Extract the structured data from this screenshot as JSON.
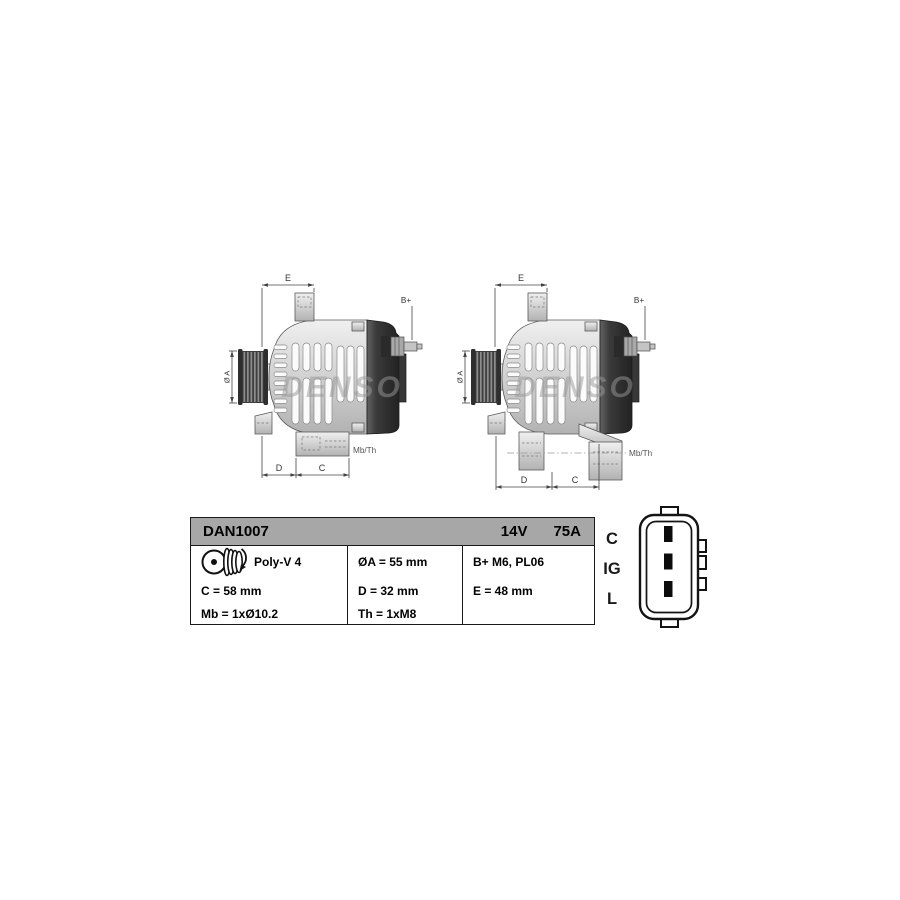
{
  "spec_table": {
    "model": "DAN1007",
    "voltage": "14V",
    "current": "75A",
    "pulley": {
      "type": "Poly-V 4"
    },
    "specs": {
      "c": "C = 58 mm",
      "mb": "Mb = 1xØ10.2",
      "dia_a": "ØA = 55 mm",
      "d": "D = 32 mm",
      "th": "Th = 1xM8",
      "b_plus": "B+ M6, PL06",
      "e": "E = 48 mm"
    }
  },
  "diagrams": {
    "watermark": "DENSO",
    "labels": {
      "e": "E",
      "b_plus": "B+",
      "dia_a": "Ø A",
      "mb_th": "Mb/Th",
      "d": "D",
      "c": "C"
    }
  },
  "connector": {
    "pins": [
      "C",
      "IG",
      "L"
    ]
  },
  "colors": {
    "background": "#ffffff",
    "table_header": "#a7a7a7",
    "body_light": "#d6d6d6",
    "housing_dark": "#3a3a3a",
    "dimension_line": "#444444",
    "watermark_gray": "#999999"
  }
}
